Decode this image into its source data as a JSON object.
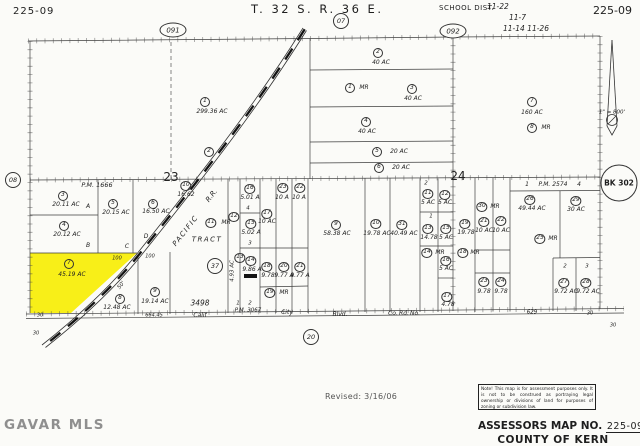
{
  "header": {
    "map_no_left": "225-09",
    "township": "T. 32 S. R. 36 E.",
    "school_dist_label": "SCHOOL DIST.",
    "school_lines": [
      "11-22",
      "11-7",
      "11-14 11-26"
    ],
    "map_no_right": "225-09"
  },
  "footer": {
    "revised": "Revised: 3/16/06",
    "note": "Note! This map is for assessment purposes only. It is not to be construed as portraying legal ownership or divisions of land for purposes of zoning or subdivision law.",
    "assessors_label": "ASSESSORS MAP NO.",
    "assessors_no": "225-09",
    "county": "COUNTY OF KERN",
    "watermark": "GAVAR MLS"
  },
  "map": {
    "highlight_color": "#f8ef18",
    "line_color": "#3f3f3f",
    "ref_circles": [
      {
        "t": "091",
        "x": 173,
        "y": 30,
        "kind": "ellipse"
      },
      {
        "t": "092",
        "x": 453,
        "y": 31,
        "kind": "ellipse"
      },
      {
        "t": "07",
        "x": 341,
        "y": 21,
        "kind": "small"
      },
      {
        "t": "08",
        "x": 13,
        "y": 180,
        "kind": "small"
      },
      {
        "t": "20",
        "x": 311,
        "y": 337,
        "kind": "small"
      },
      {
        "t": "37",
        "x": 215,
        "y": 266,
        "kind": "small"
      },
      {
        "t": "BK 302",
        "x": 619,
        "y": 183,
        "kind": "big"
      }
    ],
    "parcels": [
      {
        "num": "1",
        "x": 205,
        "y": 102,
        "ac": "299.36 AC",
        "ax": 212,
        "ay": 112
      },
      {
        "num": "2",
        "x": 209,
        "y": 152
      },
      {
        "num": "2",
        "x": 378,
        "y": 53,
        "ac": "40 AC",
        "ax": 381,
        "ay": 63
      },
      {
        "num": "1",
        "x": 350,
        "y": 88,
        "ac": "MR",
        "ax": 364,
        "ay": 88
      },
      {
        "num": "3",
        "x": 412,
        "y": 89,
        "ac": "40 AC",
        "ax": 413,
        "ay": 99
      },
      {
        "num": "4",
        "x": 366,
        "y": 122,
        "ac": "40 AC",
        "ax": 367,
        "ay": 132
      },
      {
        "num": "5",
        "x": 377,
        "y": 152,
        "ac": "20 AC",
        "ax": 399,
        "ay": 152
      },
      {
        "num": "6",
        "x": 379,
        "y": 168,
        "ac": "20 AC",
        "ax": 401,
        "ay": 168
      },
      {
        "num": "7",
        "x": 532,
        "y": 102,
        "ac": "160 AC",
        "ax": 532,
        "ay": 113
      },
      {
        "num": "8",
        "x": 532,
        "y": 128,
        "ac": "MR",
        "ax": 546,
        "ay": 128
      },
      {
        "num": "3",
        "x": 63,
        "y": 196,
        "ac": "20.11 AC",
        "ax": 66,
        "ay": 205
      },
      {
        "num": "4",
        "x": 64,
        "y": 226,
        "ac": "20.12 AC",
        "ax": 67,
        "ay": 235
      },
      {
        "num": "5",
        "x": 113,
        "y": 204,
        "ac": "20.15 AC",
        "ax": 116,
        "ay": 213
      },
      {
        "num": "6",
        "x": 153,
        "y": 204,
        "ac": "16.50 AC",
        "ax": 156,
        "ay": 212
      },
      {
        "num": "10",
        "x": 186,
        "y": 186,
        "ac": "16.62",
        "ax": 186,
        "ay": 195
      },
      {
        "num": "11",
        "x": 211,
        "y": 223,
        "ac": "MR",
        "ax": 226,
        "ay": 223
      },
      {
        "num": "7",
        "x": 69,
        "y": 264,
        "ac": "45.19 AC",
        "ax": 72,
        "ay": 275
      },
      {
        "num": "8",
        "x": 120,
        "y": 299,
        "ac": "12.48 AC",
        "ax": 117,
        "ay": 308
      },
      {
        "num": "9",
        "x": 155,
        "y": 292,
        "ac": "19.14 AC",
        "ax": 155,
        "ay": 302
      },
      {
        "num": "12",
        "x": 234,
        "y": 217
      },
      {
        "num": "13",
        "x": 240,
        "y": 258
      },
      {
        "num": "16",
        "x": 250,
        "y": 189,
        "ac": "5.01 A",
        "ax": 250,
        "ay": 198
      },
      {
        "num": "15",
        "x": 251,
        "y": 224,
        "ac": "5.02 A",
        "ax": 251,
        "ay": 233
      },
      {
        "num": "17",
        "x": 267,
        "y": 214,
        "ac": "10 AC",
        "ax": 267,
        "ay": 222
      },
      {
        "num": "23",
        "x": 283,
        "y": 188,
        "ac": "10 A",
        "ax": 282,
        "ay": 198
      },
      {
        "num": "22",
        "x": 300,
        "y": 188,
        "ac": "10 A",
        "ax": 299,
        "ay": 198
      },
      {
        "num": "14",
        "x": 251,
        "y": 261,
        "ac": "9.86 A",
        "ax": 252,
        "ay": 270
      },
      {
        "num": "18",
        "x": 267,
        "y": 267,
        "ac": "9.78",
        "ax": 268,
        "ay": 276
      },
      {
        "num": "20",
        "x": 284,
        "y": 267,
        "ac": "9.77 A",
        "ax": 284,
        "ay": 276
      },
      {
        "num": "21",
        "x": 300,
        "y": 267,
        "ac": "9.77 A",
        "ax": 300,
        "ay": 276
      },
      {
        "num": "19",
        "x": 270,
        "y": 293,
        "ac": "MR",
        "ax": 284,
        "ay": 293
      },
      {
        "num": "9",
        "x": 336,
        "y": 225,
        "ac": "58.38 AC",
        "ax": 337,
        "ay": 234
      },
      {
        "num": "10",
        "x": 376,
        "y": 224,
        "ac": "19.78 AC",
        "ax": 377,
        "ay": 234
      },
      {
        "num": "31",
        "x": 402,
        "y": 225,
        "ac": "40.49 AC",
        "ax": 404,
        "ay": 234
      },
      {
        "num": "11",
        "x": 428,
        "y": 194,
        "ac": "5 AC",
        "ax": 428,
        "ay": 203
      },
      {
        "num": "12",
        "x": 445,
        "y": 195,
        "ac": "5 AC",
        "ax": 445,
        "ay": 203
      },
      {
        "num": "13",
        "x": 428,
        "y": 229,
        "ac": "14.78",
        "ax": 429,
        "ay": 238
      },
      {
        "num": "15",
        "x": 446,
        "y": 229,
        "ac": "5 AC",
        "ax": 446,
        "ay": 238
      },
      {
        "num": "14",
        "x": 427,
        "y": 253,
        "ac": "MR",
        "ax": 440,
        "ay": 253
      },
      {
        "num": "16",
        "x": 446,
        "y": 261,
        "ac": "5 AC",
        "ax": 446,
        "ay": 269
      },
      {
        "num": "17",
        "x": 447,
        "y": 297,
        "ac": "4.78",
        "ax": 448,
        "ay": 305
      },
      {
        "num": "19",
        "x": 465,
        "y": 224,
        "ac": "19.78",
        "ax": 466,
        "ay": 233
      },
      {
        "num": "18",
        "x": 463,
        "y": 253,
        "ac": "MR",
        "ax": 475,
        "ay": 253
      },
      {
        "num": "30",
        "x": 482,
        "y": 207,
        "ac": "MR",
        "ax": 495,
        "ay": 207
      },
      {
        "num": "21",
        "x": 484,
        "y": 222,
        "ac": "10 AC",
        "ax": 484,
        "ay": 231
      },
      {
        "num": "22",
        "x": 501,
        "y": 221,
        "ac": "10 AC",
        "ax": 501,
        "ay": 231
      },
      {
        "num": "23",
        "x": 484,
        "y": 282,
        "ac": "9.78",
        "ax": 484,
        "ay": 292
      },
      {
        "num": "24",
        "x": 501,
        "y": 282,
        "ac": "9.78",
        "ax": 501,
        "ay": 292
      },
      {
        "num": "26",
        "x": 530,
        "y": 200,
        "ac": "49.44 AC",
        "ax": 532,
        "ay": 209
      },
      {
        "num": "29",
        "x": 576,
        "y": 201,
        "ac": "30 AC",
        "ax": 576,
        "ay": 210
      },
      {
        "num": "25",
        "x": 540,
        "y": 239,
        "ac": "MR",
        "ax": 553,
        "ay": 239
      },
      {
        "num": "27",
        "x": 564,
        "y": 283,
        "ac": "9.72 AC",
        "ax": 566,
        "ay": 292
      },
      {
        "num": "28",
        "x": 586,
        "y": 283,
        "ac": "9.72 AC",
        "ax": 588,
        "ay": 292
      }
    ],
    "texts": [
      {
        "t": "23",
        "x": 171,
        "y": 177,
        "s": 12,
        "rm": 1,
        "n": "section-number"
      },
      {
        "t": "24",
        "x": 458,
        "y": 176,
        "s": 12,
        "rm": 1,
        "n": "section-number"
      },
      {
        "t": "P.M. 1666",
        "x": 97,
        "y": 185,
        "s": 6.5
      },
      {
        "t": "A",
        "x": 88,
        "y": 207,
        "s": 6
      },
      {
        "t": "B",
        "x": 88,
        "y": 246,
        "s": 6
      },
      {
        "t": "C",
        "x": 127,
        "y": 247,
        "s": 6
      },
      {
        "t": "D",
        "x": 146,
        "y": 237,
        "s": 6
      },
      {
        "t": "4",
        "x": 248,
        "y": 209,
        "s": 5.5
      },
      {
        "t": "3",
        "x": 250,
        "y": 244,
        "s": 5.5
      },
      {
        "t": "2",
        "x": 426,
        "y": 184,
        "s": 5.5
      },
      {
        "t": "1",
        "x": 431,
        "y": 217,
        "s": 5.5
      },
      {
        "t": "1",
        "x": 527,
        "y": 185,
        "s": 6
      },
      {
        "t": "P.M. 2574",
        "x": 553,
        "y": 185,
        "s": 6
      },
      {
        "t": "4",
        "x": 579,
        "y": 185,
        "s": 6
      },
      {
        "t": "2",
        "x": 565,
        "y": 267,
        "s": 5.5
      },
      {
        "t": "3",
        "x": 587,
        "y": 267,
        "s": 5.5
      },
      {
        "t": "1",
        "x": 238,
        "y": 304,
        "s": 5.5
      },
      {
        "t": "2",
        "x": 250,
        "y": 304,
        "s": 5.5
      },
      {
        "t": "P.M. 3067",
        "x": 248,
        "y": 311,
        "s": 5.5
      },
      {
        "t": "TRACT",
        "x": 207,
        "y": 240,
        "s": 7,
        "ls": 1.5
      },
      {
        "t": "3498",
        "x": 200,
        "y": 303,
        "s": 7.5
      },
      {
        "t": "100",
        "x": 117,
        "y": 259,
        "s": 5
      },
      {
        "t": "100",
        "x": 150,
        "y": 257,
        "s": 5
      },
      {
        "t": "50'",
        "x": 122,
        "y": 286,
        "s": 5.5,
        "r": -50
      },
      {
        "t": "30",
        "x": 40,
        "y": 316,
        "s": 5
      },
      {
        "t": "30",
        "x": 36,
        "y": 334,
        "s": 5
      },
      {
        "t": "664.45",
        "x": 154,
        "y": 316,
        "s": 5
      },
      {
        "t": "629",
        "x": 532,
        "y": 313,
        "s": 5.5
      },
      {
        "t": "30",
        "x": 590,
        "y": 314,
        "s": 5
      },
      {
        "t": "30",
        "x": 613,
        "y": 326,
        "s": 5
      },
      {
        "t": "4.93 AC",
        "x": 233,
        "y": 271,
        "s": 5.5,
        "r": -90
      },
      {
        "t": "Calif",
        "x": 200,
        "y": 316,
        "s": 6,
        "n": "road-label"
      },
      {
        "t": "City",
        "x": 287,
        "y": 313,
        "s": 6,
        "n": "road-label"
      },
      {
        "t": "Blvd.",
        "x": 340,
        "y": 315,
        "s": 6,
        "n": "road-label"
      },
      {
        "t": "Co.",
        "x": 393,
        "y": 314,
        "s": 6,
        "n": "road-label"
      },
      {
        "t": "Rd.",
        "x": 404,
        "y": 314,
        "s": 6,
        "n": "road-label"
      },
      {
        "t": "No.",
        "x": 415,
        "y": 314,
        "s": 6,
        "n": "road-label"
      },
      {
        "t": "PACIFIC",
        "x": 186,
        "y": 231,
        "s": 7,
        "r": -52,
        "ls": 1.5,
        "n": "railroad-label"
      },
      {
        "t": "R.R.",
        "x": 212,
        "y": 196,
        "s": 7,
        "r": -52,
        "n": "railroad-label"
      },
      {
        "t": "1\" = 800'",
        "x": 612,
        "y": 113,
        "s": 5.5,
        "n": "scale-note"
      }
    ]
  }
}
